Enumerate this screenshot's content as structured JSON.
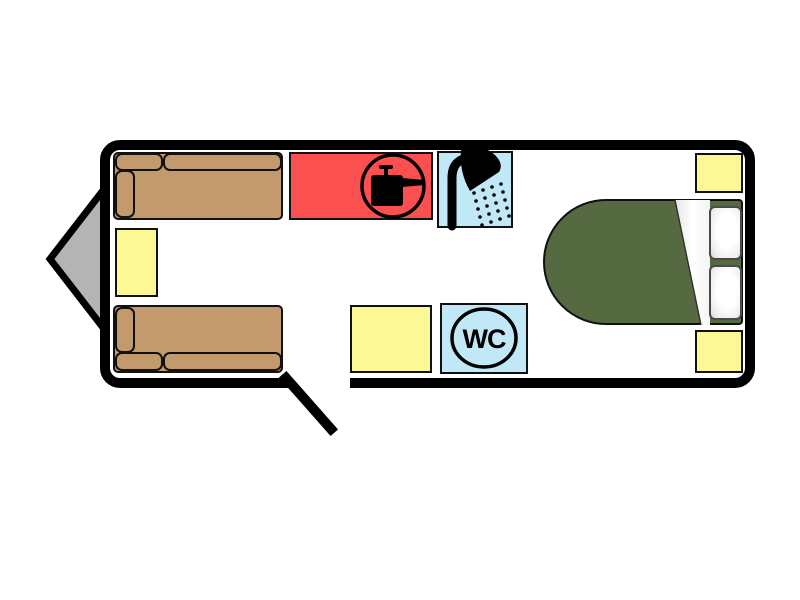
{
  "diagram": {
    "type": "caravan-floorplan",
    "labels": {
      "wc": "WC"
    },
    "colors": {
      "wall": "#000000",
      "floor": "#ffffff",
      "outline": "#111111",
      "hitch": "#b4b4b4",
      "sofa": "#c39a6b",
      "storage": "#fdf896",
      "kitchen": "#fc4f4f",
      "wetroom": "#c0e8f7",
      "bed": "#556a41",
      "pillow": "#f5f5f5",
      "sheet": "#f2f2f2"
    },
    "icons": {
      "hitch": "tow-hitch-triangle",
      "cooker": "saucepan-in-circle",
      "shower": "shower-head-with-spray",
      "wc": "wc-roundel",
      "door": "entry-door-swing"
    },
    "zones": [
      {
        "name": "front-sofa-offside"
      },
      {
        "name": "front-sofa-nearside"
      },
      {
        "name": "front-chest-table"
      },
      {
        "name": "kitchen"
      },
      {
        "name": "shower"
      },
      {
        "name": "mid-wardrobe"
      },
      {
        "name": "wc"
      },
      {
        "name": "island-bed"
      },
      {
        "name": "bedside-storage-offside"
      },
      {
        "name": "bedside-storage-nearside"
      }
    ]
  }
}
